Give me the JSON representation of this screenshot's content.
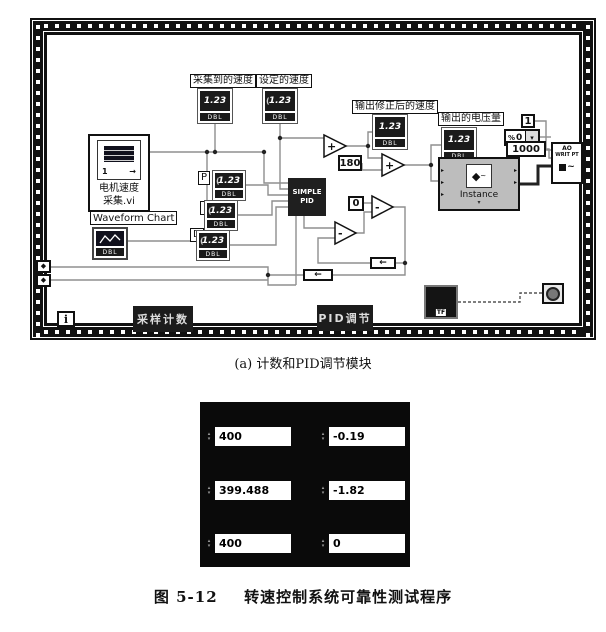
{
  "figure": {
    "subcaption": "(a) 计数和PID调节模块",
    "caption_label": "图 5-12",
    "caption_title": "转速控制系统可靠性测试程序"
  },
  "diagram": {
    "frame_tabs": {
      "left": "采样计数",
      "right": "PID调节"
    },
    "iteration_label": "i",
    "motor_vi": {
      "line1": "电机速度",
      "line2": "采集.vi",
      "icon_num": "1"
    },
    "waveform_chart_label": "Waveform Chart",
    "terminals": {
      "acquired_speed": {
        "label": "采集到的速度",
        "chip": "1.23",
        "type": "DBL"
      },
      "set_speed": {
        "label": "设定的速度",
        "chip": "1.23",
        "type": "DBL"
      },
      "corrected_speed": {
        "label": "输出修正后的速度",
        "chip": "1.23",
        "type": "DBL"
      },
      "output_voltage": {
        "label": "输出的电压量",
        "chip": "1.23",
        "type": "DBL"
      },
      "chart_type": "DBL"
    },
    "gains": {
      "p": {
        "label": "P",
        "chip": "1.23",
        "type": "DBL"
      },
      "i": {
        "label": "I",
        "chip": "1.23",
        "type": "DBL"
      },
      "d": {
        "label": "D",
        "chip": "1.23",
        "type": "DBL"
      }
    },
    "pid_block": {
      "line1": "SIMPLE",
      "line2": "PID"
    },
    "constants": {
      "c180": "180",
      "c0": "0",
      "c1": "1",
      "c1000": "1000",
      "ring_value": "0"
    },
    "operators": {
      "add": "+",
      "subtract": "-"
    },
    "instance": {
      "label": "Instance"
    },
    "ao_node": {
      "line1": "AO",
      "line2": "WRIT PT"
    },
    "boolean_terminal": "TF"
  },
  "panel": {
    "fields": [
      {
        "value": "400"
      },
      {
        "value": "-0.19"
      },
      {
        "value": "399.488"
      },
      {
        "value": "-1.82"
      },
      {
        "value": "400"
      },
      {
        "value": "0"
      }
    ]
  },
  "icons": {
    "dropdown": "▾",
    "ring_prefix": "%",
    "shift_register": "◆",
    "spinner_up": "▴",
    "spinner_down": "▾",
    "expand": "▾",
    "feedback_arrow": "←",
    "wire_arrow": "→",
    "cube": "◆",
    "wave": "~",
    "control_spinner": "("
  },
  "colors": {
    "panel_bg": "#0a0a0a",
    "instance_bg": "#bdbdbd",
    "block_bg": "#1f1f1f",
    "wire_gray": "#8f8f8f"
  }
}
